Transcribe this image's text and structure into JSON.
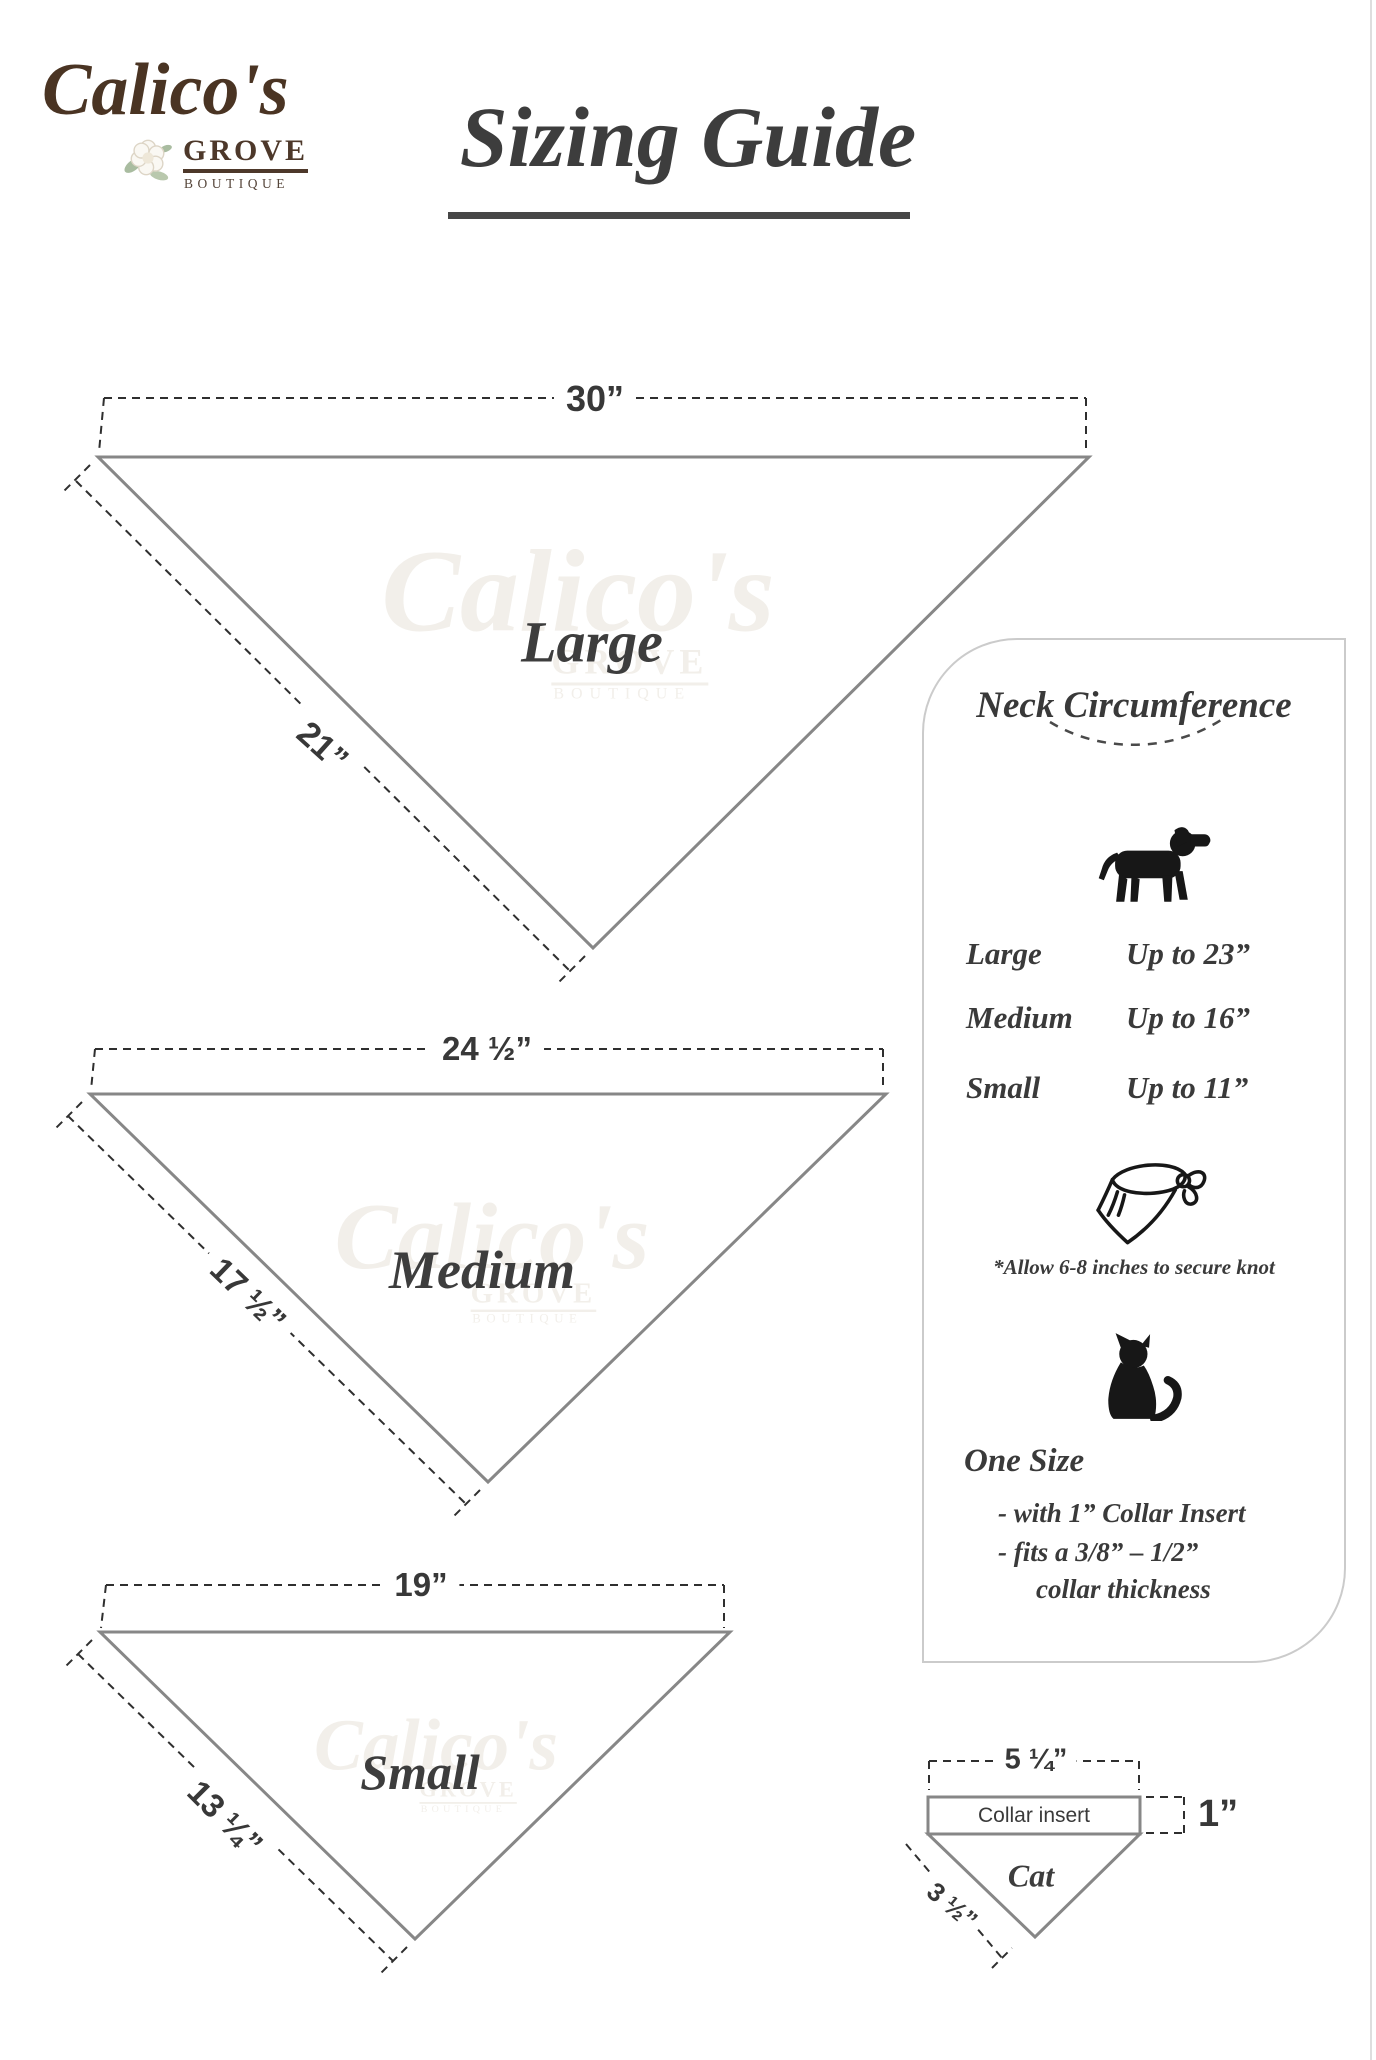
{
  "logo": {
    "script": "Calico's",
    "grove": "GROVE",
    "boutique": "BOUTIQUE",
    "flower_icon": "magnolia-flower"
  },
  "title": {
    "text": "Sizing Guide"
  },
  "watermark": {
    "script": "Calico's",
    "grove": "GROVE",
    "boutique": "BOUTIQUE"
  },
  "figures": {
    "large": {
      "name": "Large",
      "top_width": "30”",
      "side_length": "21”"
    },
    "medium": {
      "name": "Medium",
      "top_width": "24 ½”",
      "side_length": "17 ½”"
    },
    "small": {
      "name": "Small",
      "top_width": "19”",
      "side_length": "13 ¼”"
    }
  },
  "panel": {
    "title": "Neck Circumference",
    "dog_icon": "dog-silhouette",
    "rows": [
      {
        "size": "Large",
        "value": "Up to 23”"
      },
      {
        "size": "Medium",
        "value": "Up to 16”"
      },
      {
        "size": "Small",
        "value": "Up to 11”"
      }
    ],
    "bandana_icon": "tied-bandana",
    "knot_note": "*Allow 6-8 inches to secure knot",
    "cat_icon": "cat-silhouette",
    "one_size_title": "One Size",
    "one_size_line1": "- with 1” Collar Insert",
    "one_size_line2": "- fits a 3/8” – 1/2”",
    "one_size_line3": "collar thickness"
  },
  "cat_diagram": {
    "top_width": "5 ¼”",
    "insert_label": "Collar insert",
    "insert_height": "1”",
    "side_length": "3 ½”",
    "name": "Cat"
  },
  "colors": {
    "ink": "#3a3a3a",
    "line_gray": "#878787",
    "dash_dark": "#2f2f2f",
    "logo_brown": "#4a3423",
    "panel_border": "#cbcbcb",
    "watermark": "#f2efea"
  }
}
